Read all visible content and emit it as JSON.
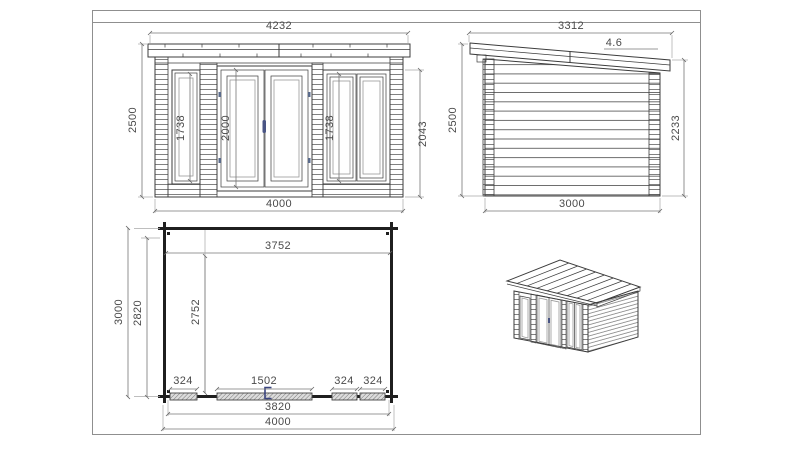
{
  "colors": {
    "line": "#3c3c3c",
    "dimension": "#777777",
    "text": "#4a4a4a",
    "plan_wall": "#1f1f1f",
    "handle_accent": "#4a5585",
    "sheet_frame": "#8f8f8f"
  },
  "front_elevation": {
    "dim_overall_width": "4232",
    "dim_height": "2500",
    "dim_window_left_height": "1738",
    "dim_door_height": "2000",
    "dim_window_right_height": "1738",
    "dim_wall_height_right": "2043",
    "dim_wall_width": "4000"
  },
  "side_elevation": {
    "dim_roof_length": "3312",
    "dim_roof_slope": "4.6",
    "dim_height_front": "2500",
    "dim_height_back": "2233",
    "dim_depth": "3000"
  },
  "floor_plan": {
    "dim_inner_width": "3752",
    "dim_depth_overall": "3000",
    "dim_depth_wall": "2820",
    "dim_inner_depth": "2752",
    "dim_window_left_width": "324",
    "dim_door_width": "1502",
    "dim_window_mid_width": "324",
    "dim_window_right_width": "324",
    "dim_base_width": "3820",
    "dim_overall_width": "4000"
  }
}
